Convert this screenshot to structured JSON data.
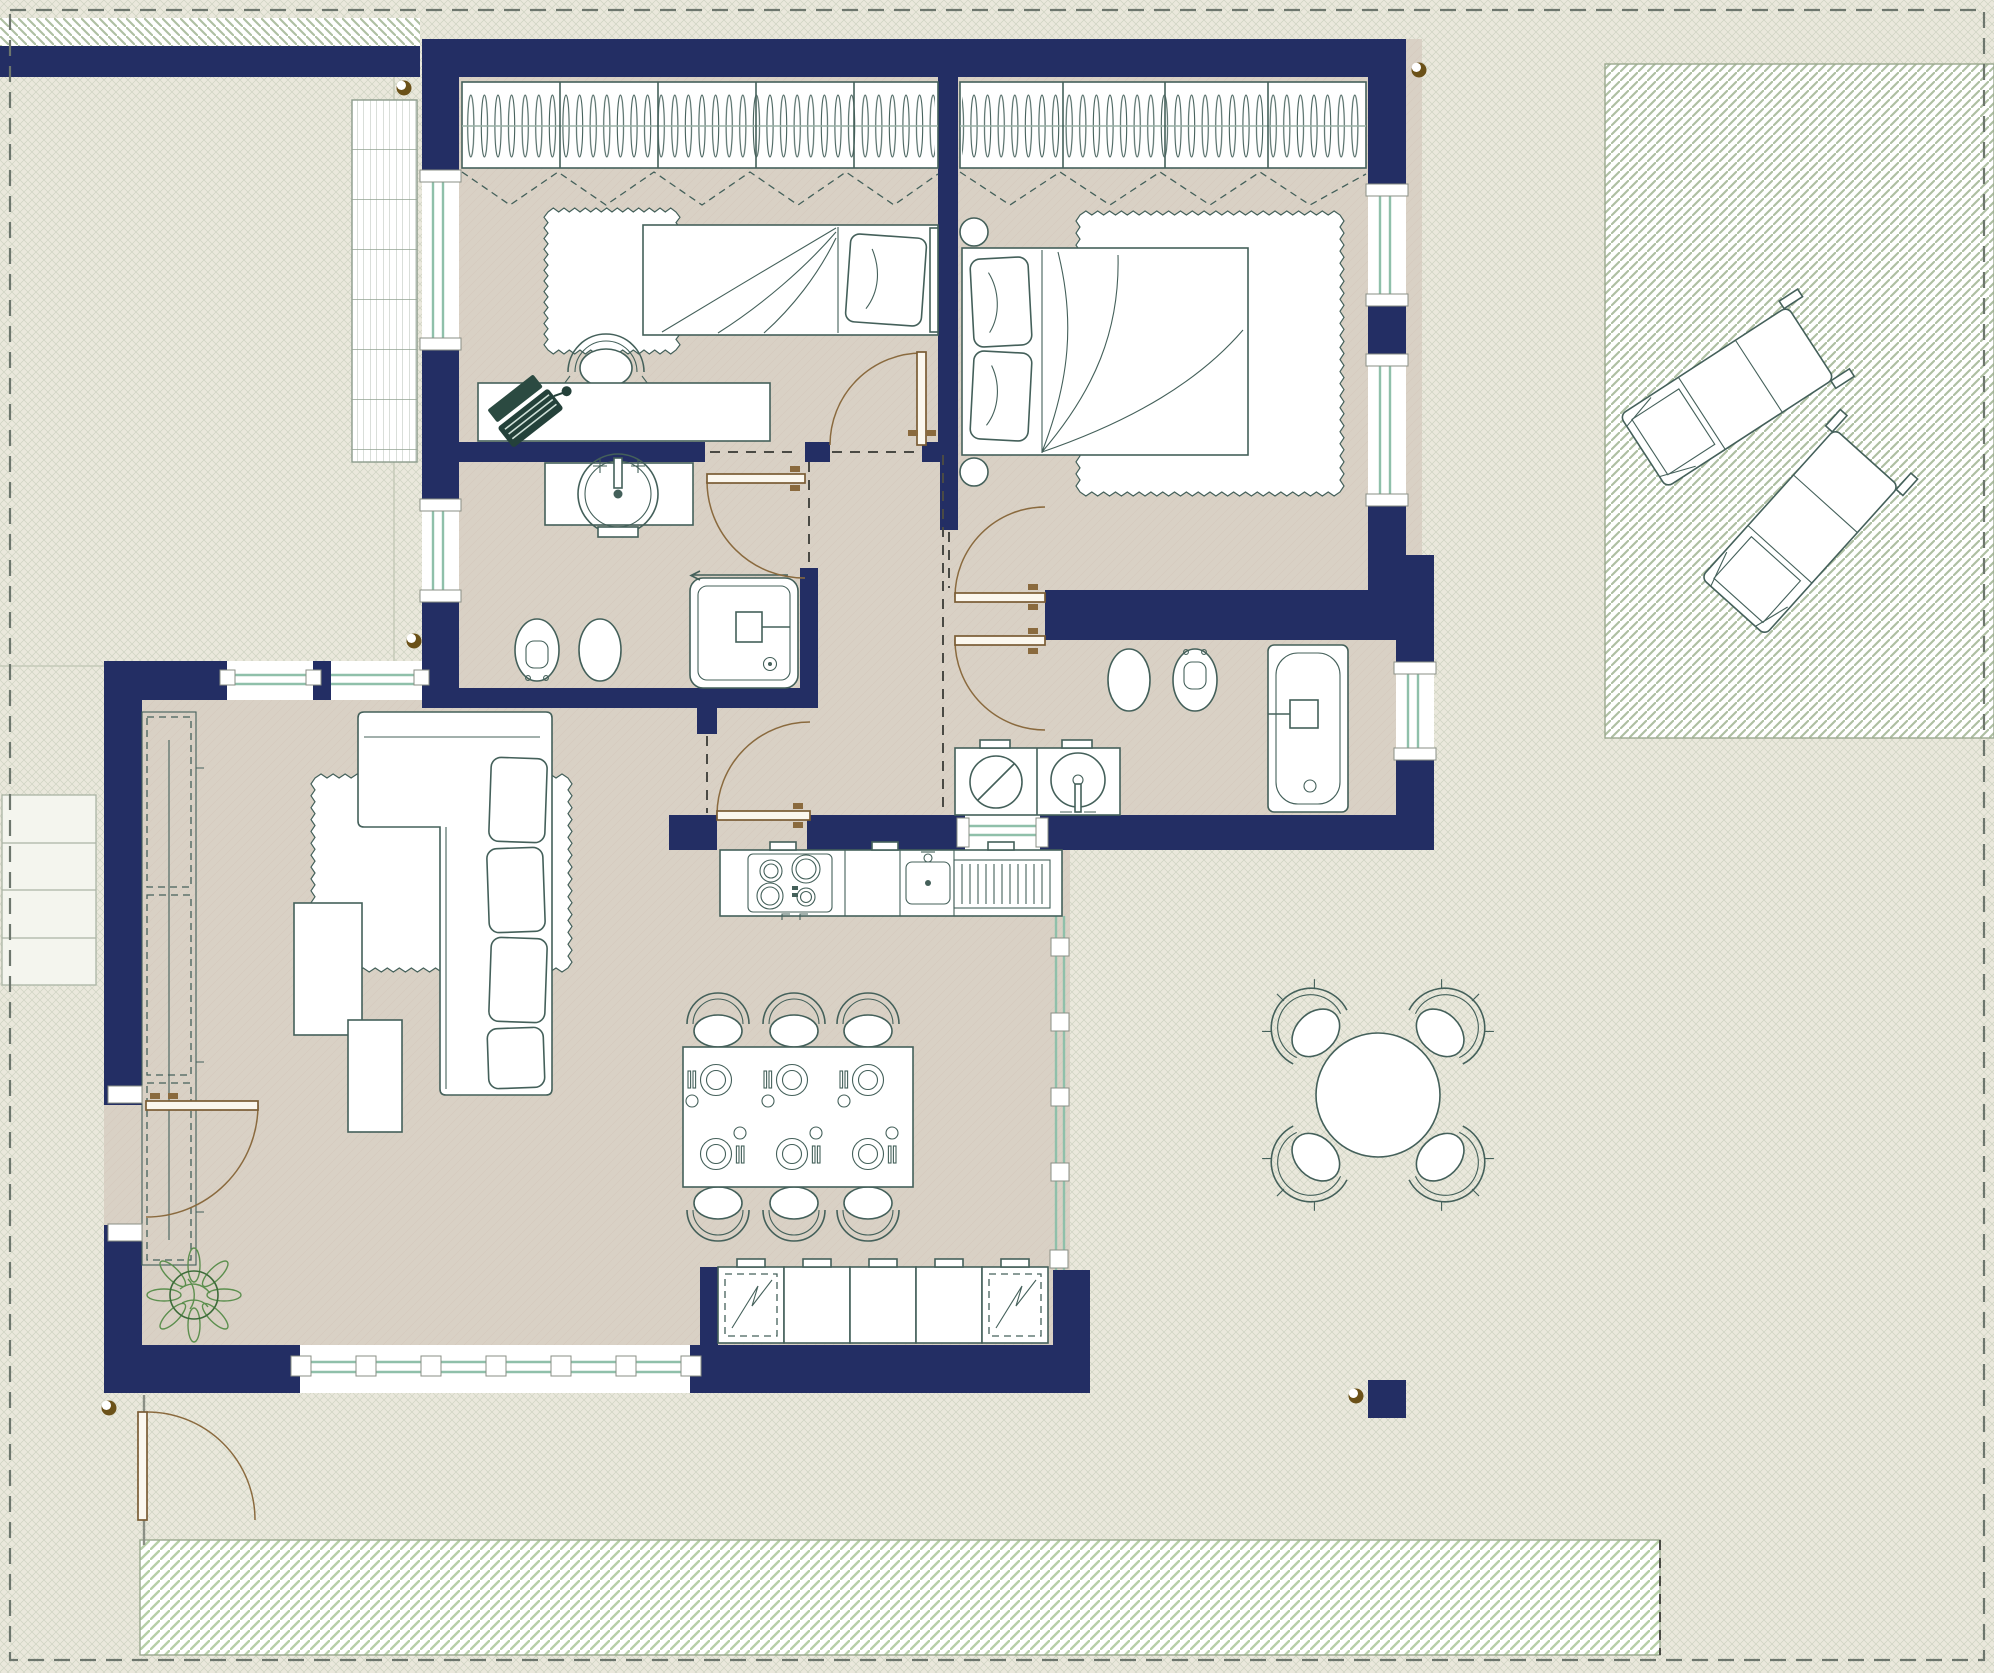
{
  "title": "Furnished apartment floor plan with terrace and garden",
  "colors": {
    "wall": "#232e64",
    "floor": "#d9d1c5",
    "floorline": "#d0c6b8",
    "paving": "#eae8dc",
    "pavingline": "#c9cfbd",
    "gardenstripe": "#aebfa2",
    "walkstripe": "#b7cfa8",
    "furn": "#44605a",
    "glaze": "#8fc0aa",
    "door": "#8a6a3e",
    "dash": "#4a4a44",
    "dot": "#6b5118",
    "white": "#ffffff"
  },
  "rooms": [
    {
      "id": "bedroom-1",
      "furniture": [
        "wardrobe-with-hangers",
        "folding-doors",
        "single-bed",
        "rug",
        "desk",
        "desk-chair",
        "laptop"
      ]
    },
    {
      "id": "bedroom-2",
      "furniture": [
        "wardrobe-with-hangers",
        "folding-doors",
        "double-bed",
        "rug",
        "bedside-table",
        "bedside-table"
      ]
    },
    {
      "id": "bathroom-1",
      "furniture": [
        "vanity-basin",
        "toilet",
        "bidet",
        "shower"
      ]
    },
    {
      "id": "bathroom-2",
      "furniture": [
        "bidet",
        "toilet",
        "bathtub",
        "washing-machine",
        "laundry-basin"
      ]
    },
    {
      "id": "hallway",
      "furniture": []
    },
    {
      "id": "living-kitchen",
      "furniture": [
        "shelving-unit",
        "sofa",
        "rug",
        "coffee-table",
        "coffee-table",
        "plant",
        "dining-table",
        "dining-chairs",
        "place-settings",
        "kitchen-counter",
        "cooktop",
        "kitchen-sink",
        "appliance-cabinets"
      ]
    }
  ],
  "outdoor": {
    "terrace": [
      "round-table",
      "outdoor-chairs"
    ],
    "garden": [
      "sun-lounger",
      "sun-lounger",
      "trellis",
      "walkway",
      "garden-gate",
      "entry-steps"
    ],
    "markers": [
      "boundary-dashed-line",
      "corner-dots",
      "freestanding-pier"
    ]
  },
  "counts": {
    "dining-chairs": 6,
    "place-settings": 6,
    "outdoor-chairs": 4,
    "sun-loungers": 2,
    "appliance-cabinets": 5,
    "wardrobe-sections": 9,
    "bathrooms": 2,
    "bedrooms": 2
  }
}
